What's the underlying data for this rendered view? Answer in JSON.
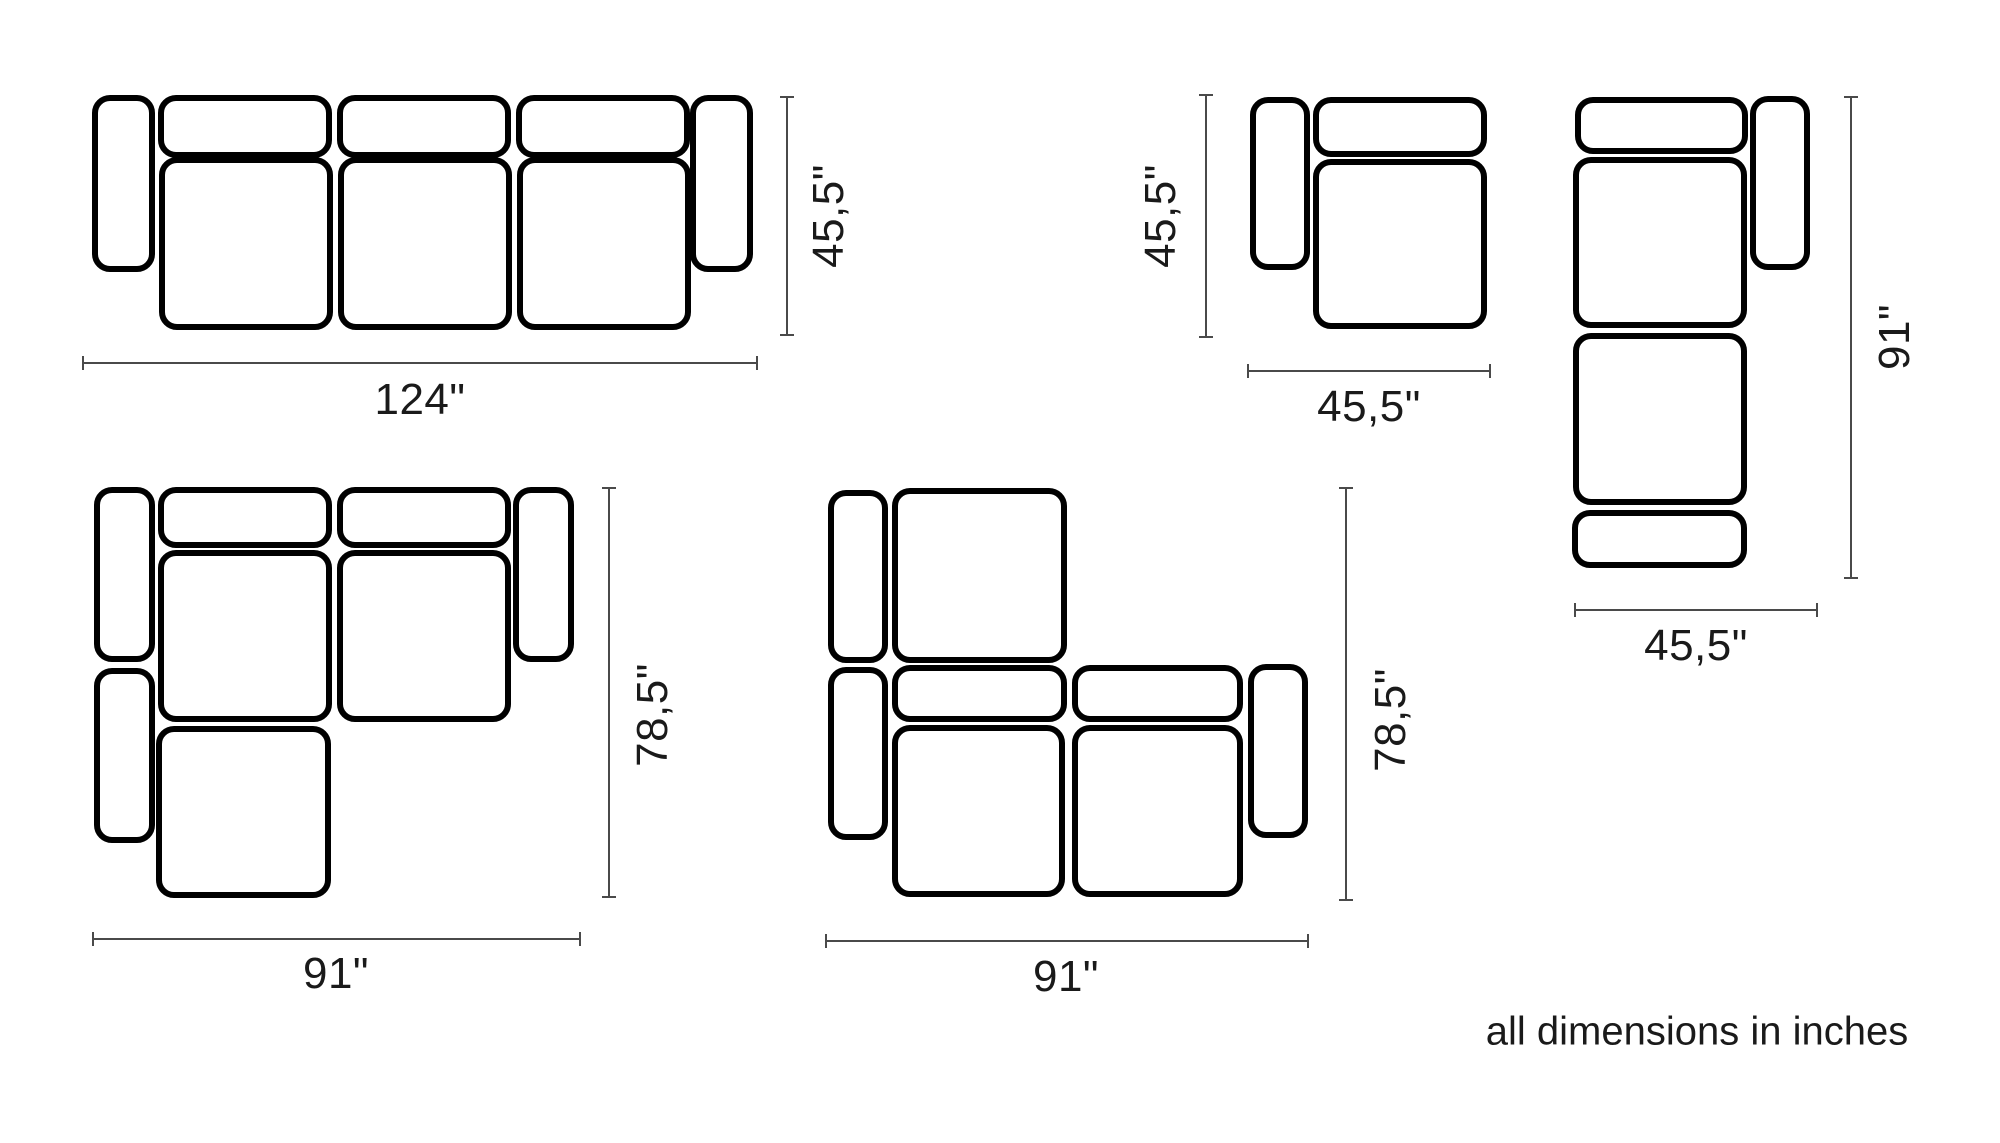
{
  "note": "all dimensions in inches",
  "colors": {
    "outline": "#000000",
    "dim_line": "#4a4a4a",
    "text": "#1a1a1a",
    "background": "#ffffff"
  },
  "configurations": [
    {
      "id": "sofa-three-seat",
      "modules": [
        {
          "type": "armrest",
          "x": 92,
          "y": 95,
          "w": 63,
          "h": 177
        },
        {
          "type": "backrest",
          "x": 158,
          "y": 95,
          "w": 174,
          "h": 63
        },
        {
          "type": "backrest",
          "x": 337,
          "y": 95,
          "w": 174,
          "h": 63
        },
        {
          "type": "backrest",
          "x": 516,
          "y": 95,
          "w": 174,
          "h": 63
        },
        {
          "type": "seat",
          "x": 159,
          "y": 157,
          "w": 174,
          "h": 173
        },
        {
          "type": "seat",
          "x": 338,
          "y": 157,
          "w": 174,
          "h": 173
        },
        {
          "type": "seat",
          "x": 517,
          "y": 157,
          "w": 174,
          "h": 173
        },
        {
          "type": "armrest",
          "x": 690,
          "y": 95,
          "w": 63,
          "h": 177
        }
      ],
      "dimensions": [
        {
          "orientation": "horizontal",
          "label": "124\"",
          "x1": 83,
          "x2": 757,
          "y": 362,
          "label_x": 420,
          "label_y": 400
        },
        {
          "orientation": "vertical",
          "label": "45,5\"",
          "y1": 97,
          "y2": 335,
          "x": 786,
          "label_x": 829,
          "label_y": 216
        }
      ]
    },
    {
      "id": "armchair-module",
      "modules": [
        {
          "type": "armrest",
          "x": 1250,
          "y": 97,
          "w": 60,
          "h": 173
        },
        {
          "type": "backrest",
          "x": 1313,
          "y": 97,
          "w": 174,
          "h": 60
        },
        {
          "type": "seat",
          "x": 1313,
          "y": 159,
          "w": 174,
          "h": 170
        }
      ],
      "dimensions": [
        {
          "orientation": "vertical",
          "label": "45,5\"",
          "y1": 95,
          "y2": 337,
          "x": 1205,
          "label_x": 1161,
          "label_y": 216
        },
        {
          "orientation": "horizontal",
          "label": "45,5\"",
          "x1": 1248,
          "x2": 1490,
          "y": 370,
          "label_x": 1369,
          "label_y": 407
        }
      ]
    },
    {
      "id": "chaise-module",
      "modules": [
        {
          "type": "backrest",
          "x": 1575,
          "y": 97,
          "w": 173,
          "h": 57
        },
        {
          "type": "armrest",
          "x": 1750,
          "y": 96,
          "w": 60,
          "h": 174
        },
        {
          "type": "seat",
          "x": 1573,
          "y": 157,
          "w": 174,
          "h": 171
        },
        {
          "type": "seat",
          "x": 1573,
          "y": 333,
          "w": 174,
          "h": 172
        },
        {
          "type": "backrest",
          "x": 1572,
          "y": 510,
          "w": 175,
          "h": 58
        }
      ],
      "dimensions": [
        {
          "orientation": "vertical",
          "label": "91\"",
          "y1": 97,
          "y2": 578,
          "x": 1850,
          "label_x": 1895,
          "label_y": 337
        },
        {
          "orientation": "horizontal",
          "label": "45,5\"",
          "x1": 1575,
          "x2": 1817,
          "y": 609,
          "label_x": 1696,
          "label_y": 646
        }
      ]
    },
    {
      "id": "sectional-left-chaise",
      "modules": [
        {
          "type": "armrest",
          "x": 94,
          "y": 487,
          "w": 61,
          "h": 175
        },
        {
          "type": "backrest",
          "x": 158,
          "y": 487,
          "w": 174,
          "h": 61
        },
        {
          "type": "backrest",
          "x": 337,
          "y": 487,
          "w": 174,
          "h": 61
        },
        {
          "type": "armrest",
          "x": 513,
          "y": 487,
          "w": 61,
          "h": 175
        },
        {
          "type": "seat",
          "x": 158,
          "y": 550,
          "w": 174,
          "h": 172
        },
        {
          "type": "seat",
          "x": 337,
          "y": 550,
          "w": 174,
          "h": 172
        },
        {
          "type": "armrest",
          "x": 94,
          "y": 668,
          "w": 61,
          "h": 175
        },
        {
          "type": "seat",
          "x": 156,
          "y": 726,
          "w": 175,
          "h": 172
        }
      ],
      "dimensions": [
        {
          "orientation": "vertical",
          "label": "78,5\"",
          "y1": 488,
          "y2": 897,
          "x": 608,
          "label_x": 653,
          "label_y": 715
        },
        {
          "orientation": "horizontal",
          "label": "91\"",
          "x1": 93,
          "x2": 580,
          "y": 938,
          "label_x": 336,
          "label_y": 974
        }
      ]
    },
    {
      "id": "sectional-corner-chaise",
      "modules": [
        {
          "type": "armrest",
          "x": 828,
          "y": 490,
          "w": 60,
          "h": 173
        },
        {
          "type": "seat",
          "x": 892,
          "y": 488,
          "w": 175,
          "h": 175
        },
        {
          "type": "armrest",
          "x": 828,
          "y": 667,
          "w": 60,
          "h": 173
        },
        {
          "type": "backrest",
          "x": 892,
          "y": 665,
          "w": 175,
          "h": 57
        },
        {
          "type": "backrest",
          "x": 1072,
          "y": 665,
          "w": 171,
          "h": 57
        },
        {
          "type": "seat",
          "x": 892,
          "y": 725,
          "w": 173,
          "h": 172
        },
        {
          "type": "seat",
          "x": 1072,
          "y": 725,
          "w": 171,
          "h": 172
        },
        {
          "type": "armrest",
          "x": 1248,
          "y": 664,
          "w": 60,
          "h": 174
        }
      ],
      "dimensions": [
        {
          "orientation": "vertical",
          "label": "78,5\"",
          "y1": 488,
          "y2": 900,
          "x": 1345,
          "label_x": 1391,
          "label_y": 720
        },
        {
          "orientation": "horizontal",
          "label": "91\"",
          "x1": 826,
          "x2": 1308,
          "y": 940,
          "label_x": 1066,
          "label_y": 977
        }
      ]
    }
  ],
  "note_position": {
    "x": 1697,
    "y": 1032
  }
}
